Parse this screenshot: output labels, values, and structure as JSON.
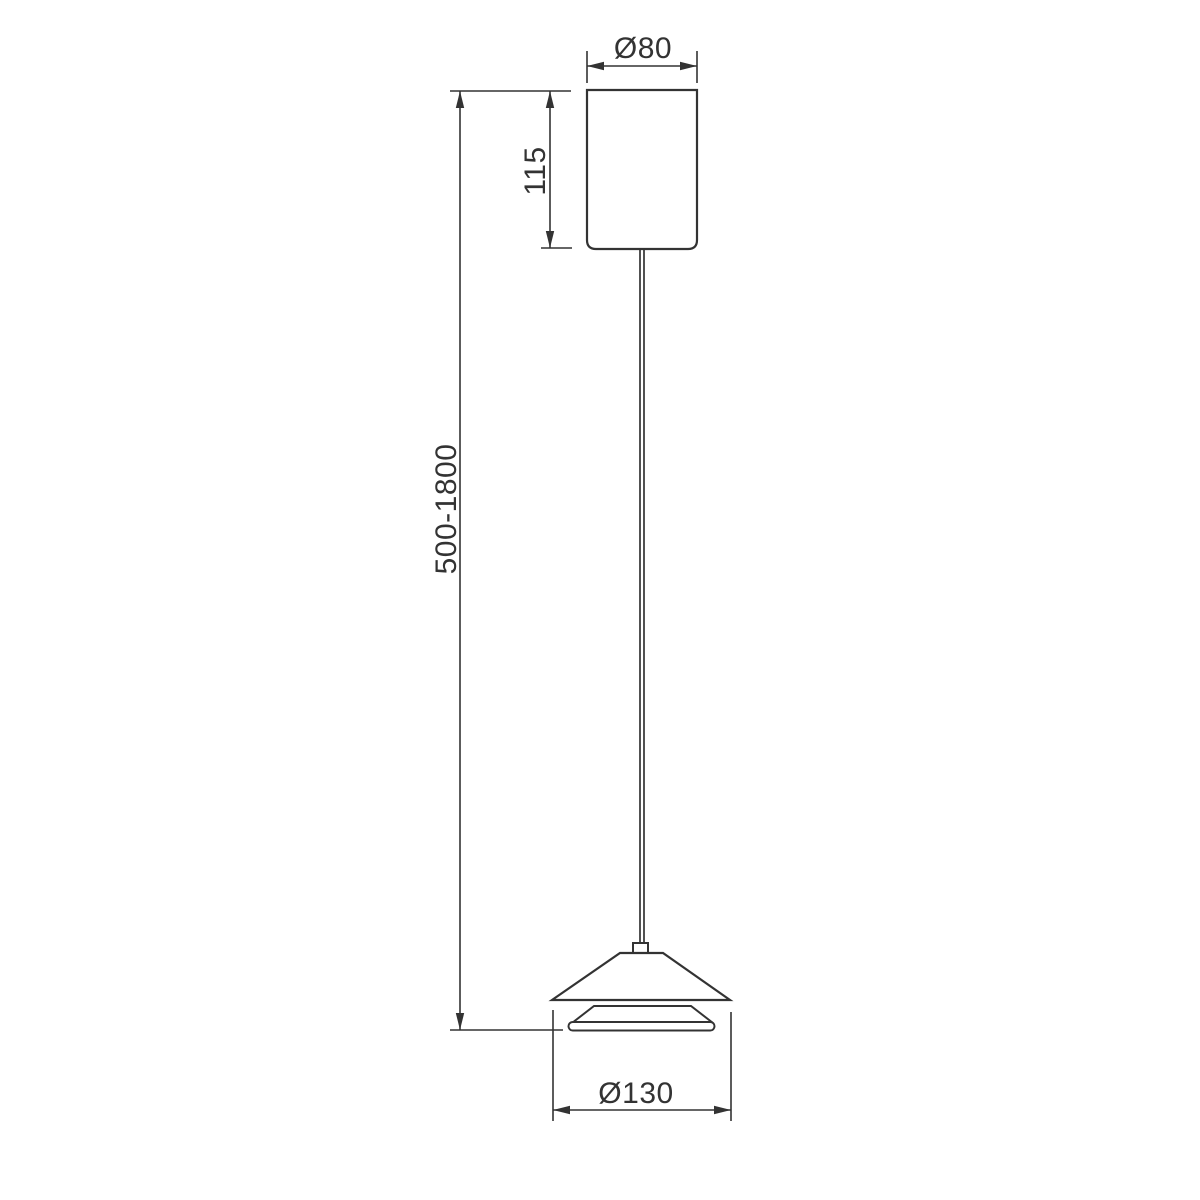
{
  "page": {
    "background": "#ffffff"
  },
  "drawing": {
    "kind": "technical-dimension-drawing",
    "subject": "pendant-lamp",
    "stroke_color": "#333333",
    "labels": {
      "canopy_diameter": "Ø80",
      "canopy_height": "115",
      "suspension_length": "500-1800",
      "shade_diameter": "Ø130"
    }
  }
}
